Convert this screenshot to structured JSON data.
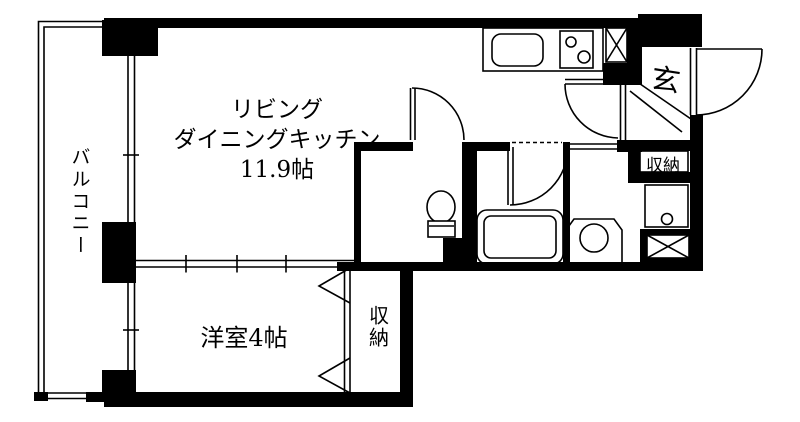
{
  "plan": {
    "type": "japanese-apartment-floor-plan",
    "colors": {
      "wall": "#000000",
      "floor": "#ffffff",
      "line": "#000000"
    },
    "rooms": {
      "ldk": {
        "name_line1": "リビング",
        "name_line2": "ダイニングキッチン",
        "name_line3": "11.9帖"
      },
      "bedroom": {
        "label": "洋室4帖"
      },
      "balcony": {
        "label": "バルコニー"
      },
      "entrance": {
        "label": "玄"
      },
      "entrance_storage": {
        "label": "収納"
      },
      "bedroom_storage": {
        "label": "収納"
      }
    },
    "fixtures": {
      "kitchen_sink": "kitchen-sink-icon",
      "stove": "two-burner-stove-icon",
      "toilet": "toilet-icon",
      "bathtub": "bathtub-icon",
      "washing_machine": "washing-machine-pan-icon",
      "washbasin": "washbasin-icon",
      "pipe_shaft_top": "pipe-shaft-x-icon",
      "pipe_shaft_bottom": "pipe-shaft-x-icon"
    }
  }
}
